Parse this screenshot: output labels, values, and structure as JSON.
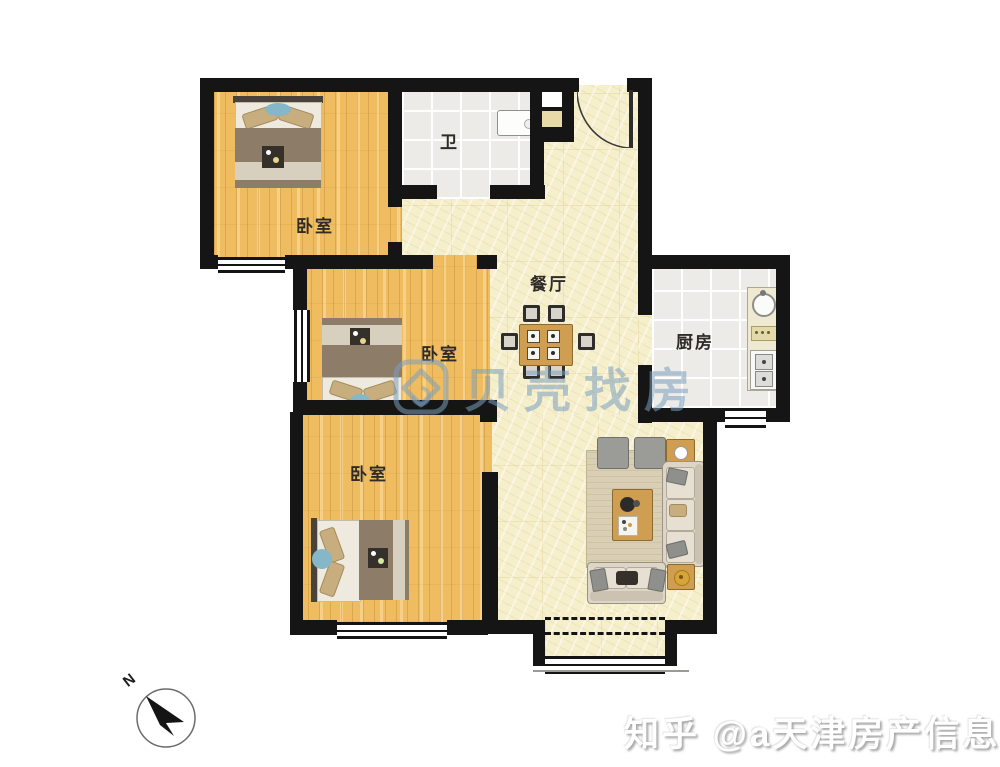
{
  "rooms": {
    "bedroom_top": {
      "label": "卧室"
    },
    "bathroom": {
      "label": "卫"
    },
    "dining": {
      "label": "餐厅"
    },
    "kitchen": {
      "label": "厨房"
    },
    "bedroom_middle": {
      "label": "卧室"
    },
    "bedroom_bottom": {
      "label": "卧室"
    }
  },
  "watermarks": {
    "beike_text": "贝壳找房",
    "zhihu_text": "知乎 @a天津房产信息佳"
  },
  "compass": {
    "north_label": "N"
  },
  "colors": {
    "wall": "#151515",
    "wood_floor": "#efbc60",
    "tile_floor": "#ecebe7",
    "hall_floor": "#f6efcc",
    "watermark_blue": "#7a9ec0",
    "bed_accent_blue": "#85b7c9"
  }
}
